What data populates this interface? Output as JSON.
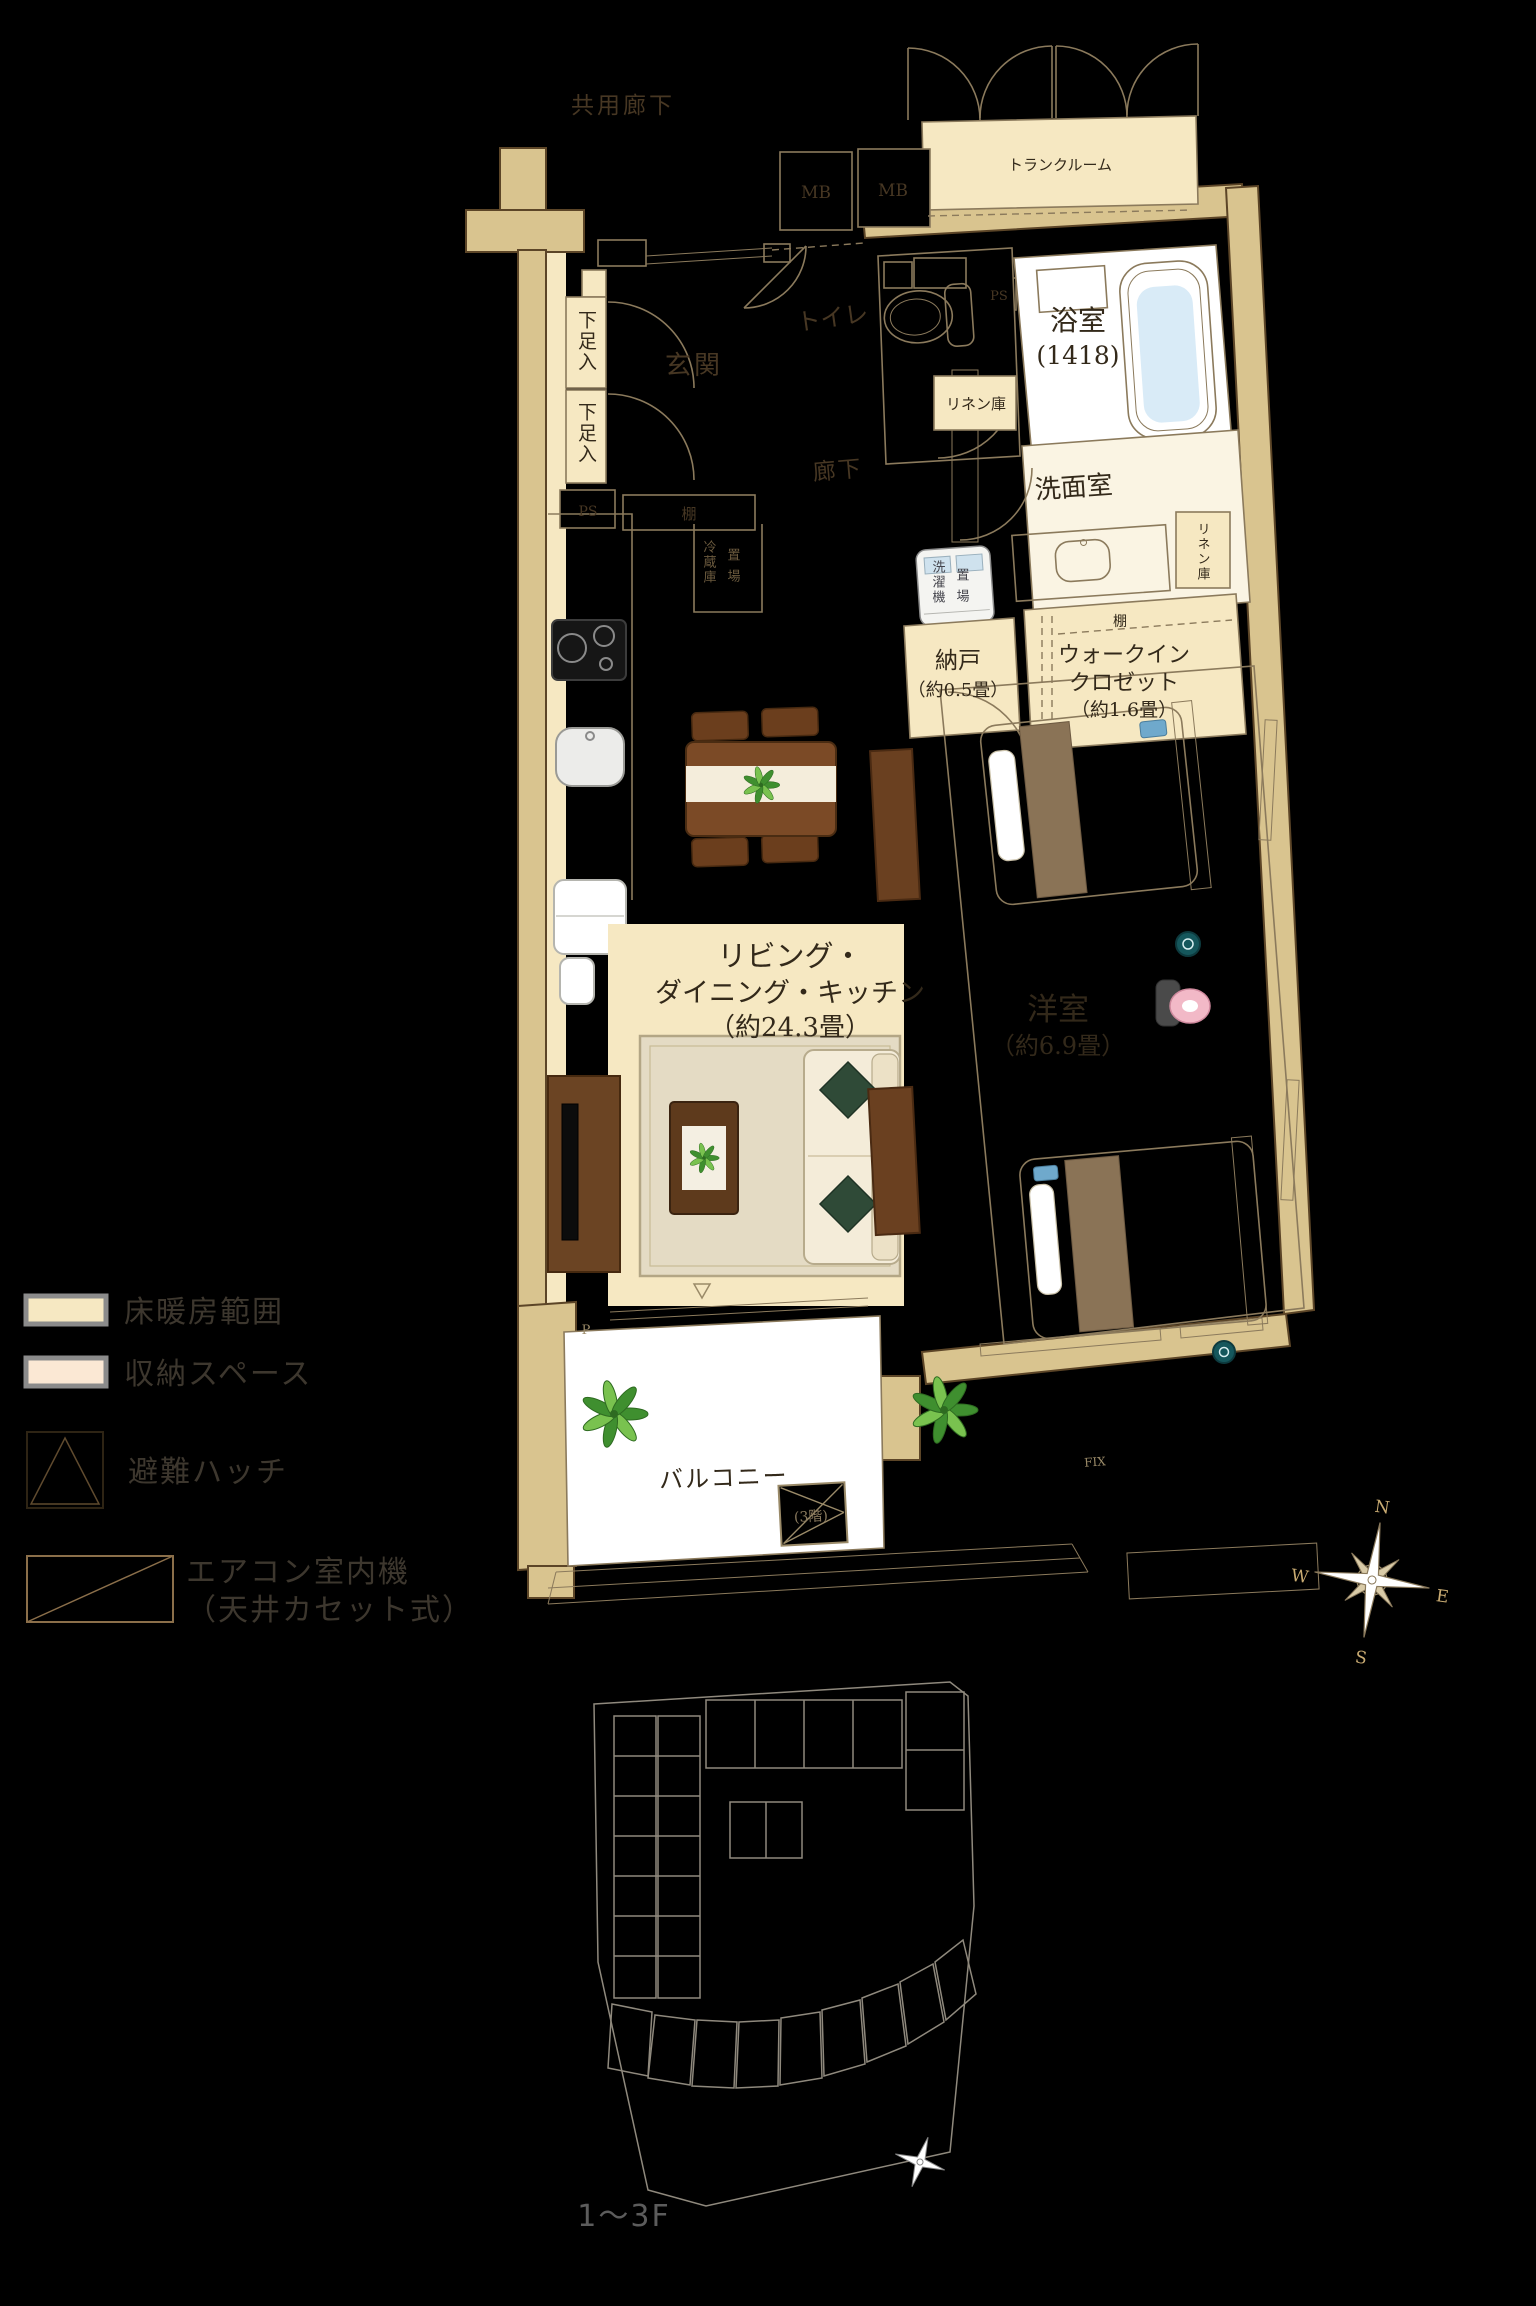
{
  "page": {
    "background": "#000000"
  },
  "plan": {
    "common_corridor": "共用廊下",
    "mb": "MB",
    "trunk_room": "トランクルーム",
    "ps": "PS",
    "bath_name": "浴室",
    "bath_size": "(1418)",
    "toilet": "トイレ",
    "entrance": "玄関",
    "shoe_cabinet": "下足入",
    "shelf": "棚",
    "corridor": "廊下",
    "linen": "リネン庫",
    "washroom": "洗面室",
    "washer_l1": "洗濯機",
    "washer_l2": "置場",
    "storage_name": "納戸",
    "storage_size": "（約0.5畳）",
    "wic_l1": "ウォークイン",
    "wic_l2": "クロゼット",
    "wic_size": "（約1.6畳）",
    "fridge_l1": "冷蔵庫",
    "fridge_l2": "置場",
    "ldk_l1": "リビング・",
    "ldk_l2": "ダイニング・キッチン",
    "ldk_size": "（約24.3畳）",
    "bedroom_name": "洋室",
    "bedroom_size": "（約6.9畳）",
    "balcony": "バルコニー",
    "hatch_floor": "(3階)",
    "fix": "FIX",
    "p_mark": "P"
  },
  "legend": {
    "items": [
      {
        "label": "床暖房範囲"
      },
      {
        "label": "収納スペース"
      },
      {
        "label": "避難ハッチ"
      },
      {
        "label": "エアコン室内機",
        "label2": "（天井カセット式）"
      }
    ]
  },
  "compass": {
    "n": "N",
    "e": "E",
    "s": "S",
    "w": "W"
  },
  "site_plan": {
    "floor_label": "1〜3F"
  },
  "colors": {
    "background": "#000000",
    "wall_fill": "#d9c48f",
    "wall_stroke": "#5c4527",
    "drawing_line": "#8b7a5c",
    "floor_heating": "#f6e8c2",
    "storage_space": "#fbe8d4",
    "white_room": "#ffffff",
    "bedroom_floor": "#f8f1dc",
    "bathtub_water": "#d9ebf7",
    "label_dark": "#33291a",
    "label_on_black": "#473723",
    "legend_text": "#3d372e",
    "compass_letter": "#c9ab72",
    "site_outline": "#8f897d",
    "highlight_unit": "#d9c592"
  }
}
